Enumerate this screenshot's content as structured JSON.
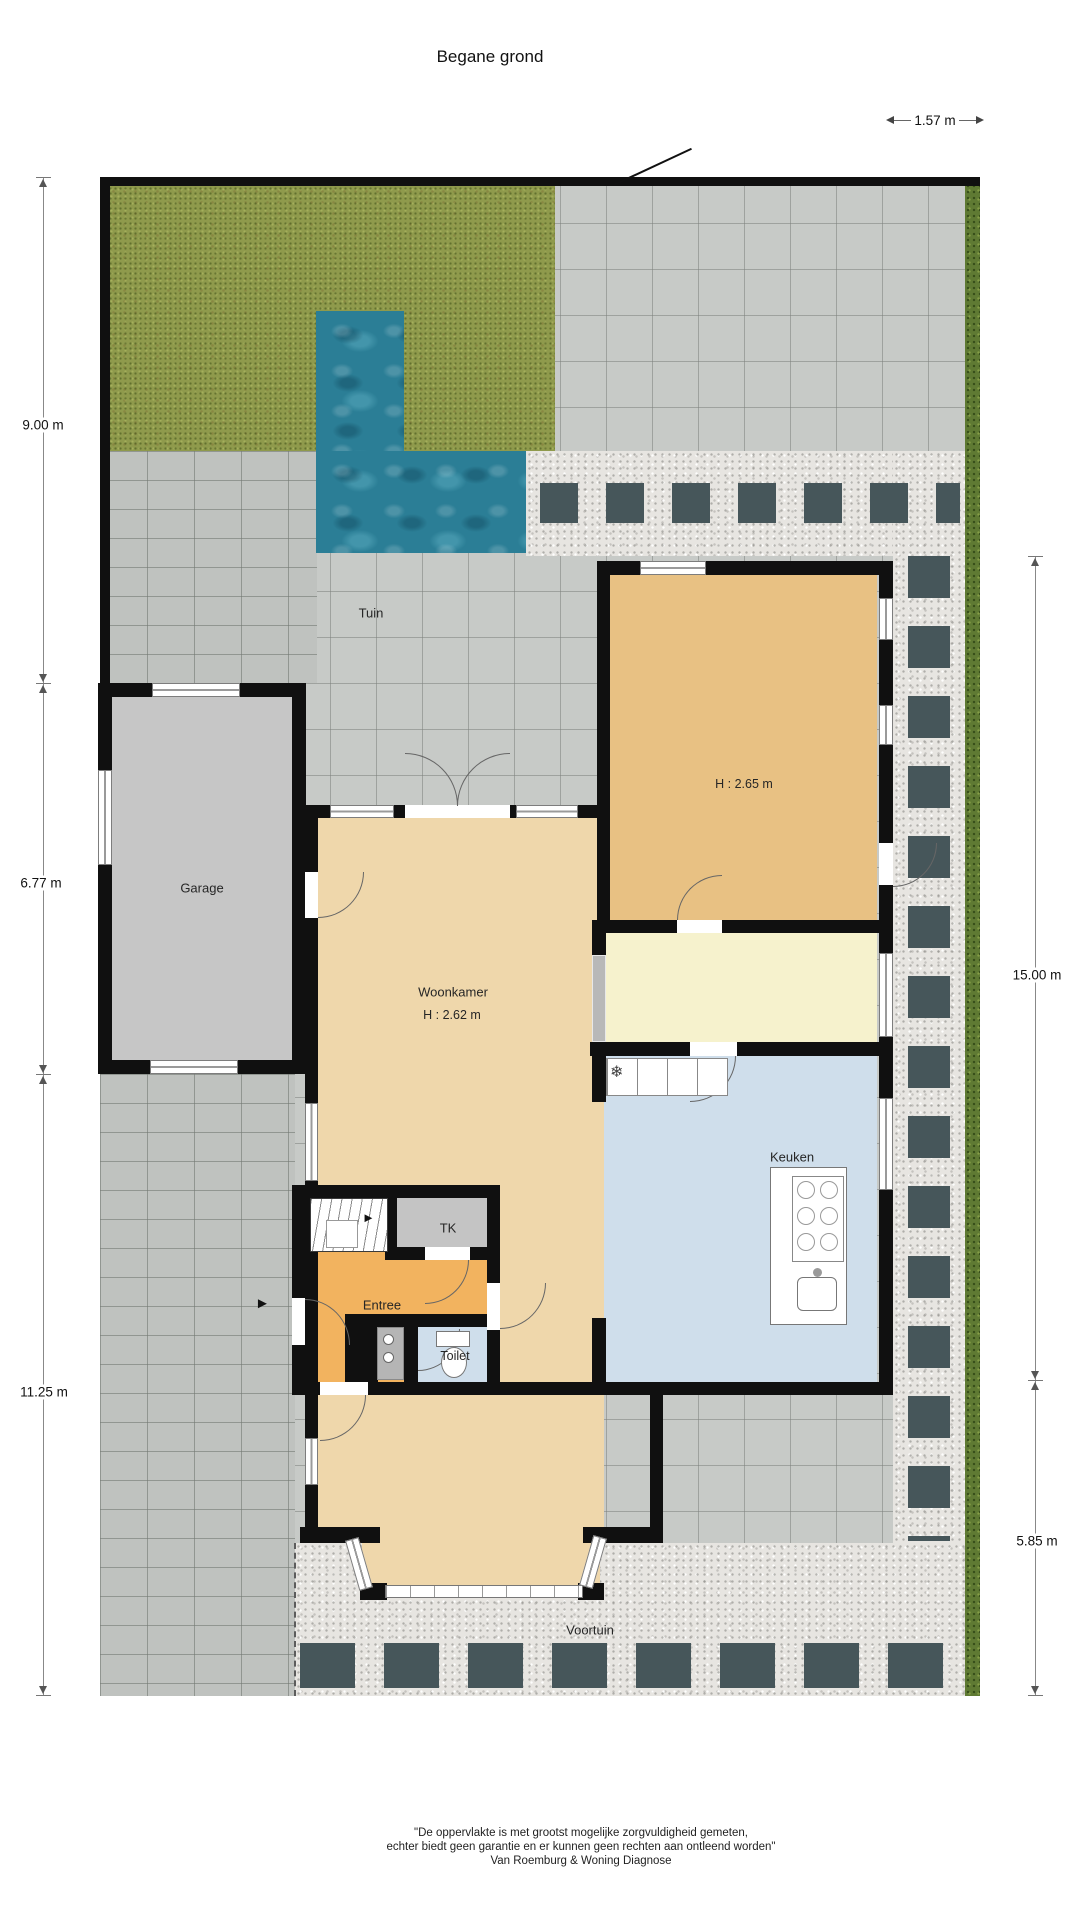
{
  "title": "Begane grond",
  "dimensions": {
    "width_top": "1.57 m",
    "left": [
      "9.00 m",
      "6.77 m",
      "11.25 m"
    ],
    "right": [
      "15.00 m",
      "5.85 m"
    ]
  },
  "rooms": {
    "tuin": "Tuin",
    "garage": "Garage",
    "back_room_height": "H : 2.65 m",
    "woonkamer": "Woonkamer",
    "woonkamer_height": "H : 2.62 m",
    "keuken": "Keuken",
    "tk": "TK",
    "entree": "Entree",
    "toilet": "Toilet",
    "voortuin": "Voortuin"
  },
  "footer": [
    "\"De oppervlakte is met grootst mogelijke zorgvuldigheid gemeten,",
    "echter biedt geen garantie en er kunnen geen rechten aan ontleend worden\"",
    "Van Roemburg & Woning Diagnose"
  ],
  "icons": {
    "freezer": "❄",
    "entrance_arrow": "►",
    "stairs_arrow": "►"
  },
  "colors": {
    "wall": "#101010",
    "grass": "#8f9a4c",
    "pool": "#2b7e96",
    "paving": "#c7cac7",
    "gravel": "#e7e5e1",
    "dark_tile": "#46565a",
    "hedge": "#5f7a33",
    "floor_back_room": "#e8c183",
    "floor_woonkamer": "#efd7ab",
    "floor_bijkeuken": "#f6f2cd",
    "floor_keuken": "#cfdeeb",
    "floor_entree": "#f2b35f",
    "floor_garage": "#c6c6c6"
  }
}
